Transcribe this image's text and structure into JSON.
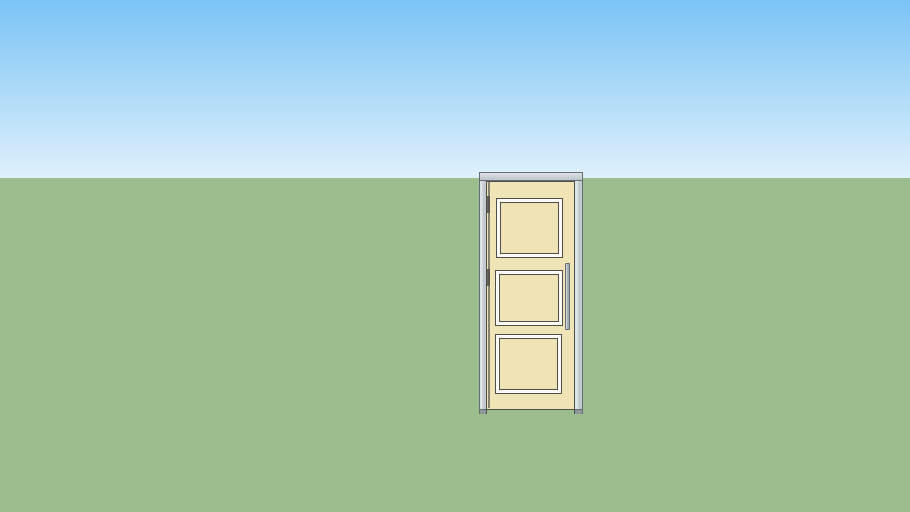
{
  "app": {
    "name": "3D model viewport",
    "description": "SketchUp-style 3D scene showing a single three-panel interior door standing upright on a flat green ground plane under a blue gradient sky"
  },
  "colors": {
    "sky-top": "#79c3f5",
    "sky-horizon": "#dff0fb",
    "ground": "#9cbe8f",
    "door-slab": "#f0e4b6",
    "panel-face": "#fbfaf3",
    "sketch-outline": "#4d4f4a",
    "frame-gray": "#c2cacf",
    "frame-light": "#dde2e5",
    "frame-edge": "#666d72",
    "frame-foot": "#8f979d",
    "handle-gray": "#a7b1b5",
    "handle-light": "#ced5d8"
  },
  "scene": {
    "objects": [
      {
        "name": "sky",
        "type": "gradient-backdrop"
      },
      {
        "name": "ground",
        "type": "flat-plane"
      },
      {
        "name": "door",
        "type": "model",
        "panels": 3,
        "handle_side": "right",
        "hinge_side": "left"
      }
    ]
  }
}
